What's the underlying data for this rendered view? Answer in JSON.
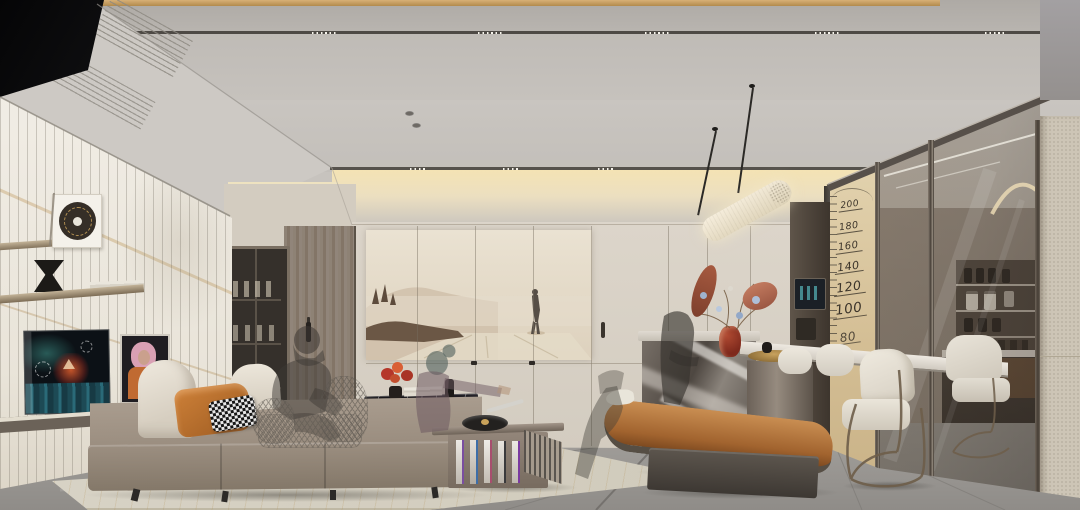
{
  "scene": {
    "height_chart": {
      "marks": [
        "200",
        "180",
        "160",
        "140",
        "120",
        "100",
        "80"
      ]
    },
    "colors": {
      "gold_trim": "#c8a265",
      "ceiling_upper": "#b5b1ac",
      "ceiling_main": "#c8c4bf",
      "cove_glow": "#f1dfae",
      "marble_wall": "#efebe2",
      "wall_beige": "#d7d0c5",
      "wood_door": "#87796c",
      "bronze": "#5c5248",
      "height_wall_tan": "#dcc8a2",
      "chart_ink": "#3b342a",
      "glass_smoke": "#7c7268",
      "leather_column": "#cdc5b6",
      "floor_gray": "#9c9996",
      "rug_beige": "#d6d1c3",
      "sofa_taupe": "#97897b",
      "cushion_cream": "#e9e3d8",
      "pillow_orange": "#c17836",
      "bench_caramel": "#b67b43",
      "plinth_bronze": "#4e4841",
      "island_marble": "#6b635c",
      "tabletop_white": "#e5e1d9",
      "chair_white": "#eae5db",
      "coffee_table_black": "#1a191d",
      "brass_leg": "#b08d52",
      "vase_red": "#8e3020",
      "flower_blue": "#a7b9d4",
      "flower_coral": "#bb6a4d",
      "tv_screen_dark": "#0c1116",
      "tv_teal": "#2e6f6a",
      "ghost_gray": "#3c3733"
    }
  }
}
